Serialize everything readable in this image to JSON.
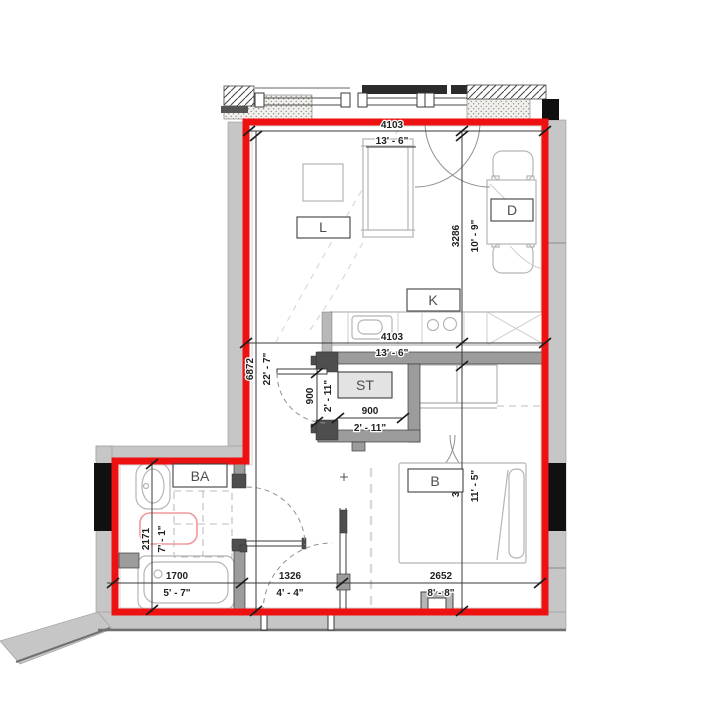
{
  "title": "apartment-floor-plan",
  "colors": {
    "boundary_red": "#ee1111",
    "exterior_wall_gray": "#c6c6c6",
    "partition_gray": "#9c9c9c",
    "door_post_dark": "#4e4e4e",
    "structural_black": "#101010",
    "furniture_line": "#b5b5b5",
    "dimension_text": "#1f1f1f",
    "storage_label_fill": "#e3e3e3",
    "shower_red": "#f09898"
  },
  "rooms": {
    "living": "L",
    "dining": "D",
    "kitchen": "K",
    "storage": "ST",
    "bathroom": "BA",
    "bedroom": "B"
  },
  "dimensions": {
    "top_width": {
      "mm": "4103",
      "imperial": "13' - 6\""
    },
    "living_depth": {
      "mm": "3286",
      "imperial": "10' - 9\""
    },
    "kitchen_width": {
      "mm": "4103",
      "imperial": "13' - 6\""
    },
    "unit_depth": {
      "mm": "6872",
      "imperial": "22' - 7\""
    },
    "storage_door": {
      "mm": "900",
      "imperial": "2' - 11\""
    },
    "storage_width": {
      "mm": "900",
      "imperial": "2' - 11\""
    },
    "bathroom_depth": {
      "mm": "2171",
      "imperial": "7' - 1\""
    },
    "bedroom_depth": {
      "mm": "3485",
      "imperial": "11' - 5\""
    },
    "bathroom_width": {
      "mm": "1700",
      "imperial": "5' - 7\""
    },
    "hall_width": {
      "mm": "1326",
      "imperial": "4' - 4\""
    },
    "bedroom_width": {
      "mm": "2652",
      "imperial": "8' - 8\""
    }
  }
}
